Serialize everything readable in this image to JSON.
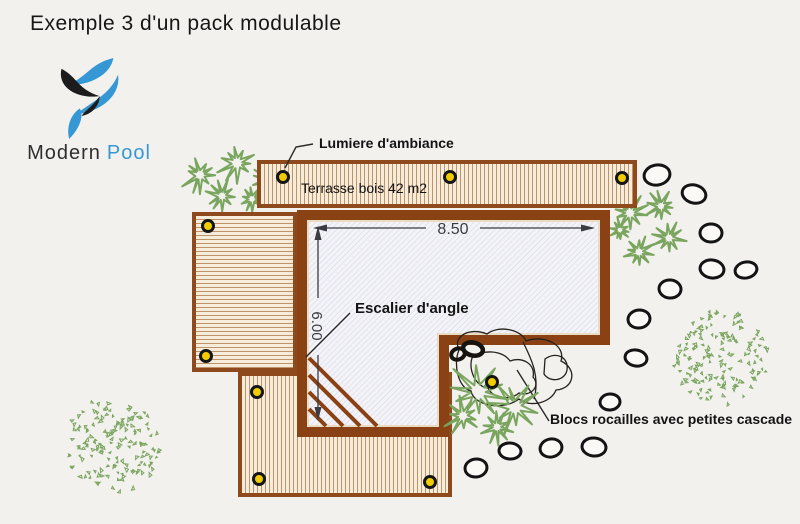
{
  "title": "Exemple 3 d'un pack modulable",
  "logo": {
    "brand_primary": "Modern",
    "brand_secondary": "Pool",
    "brand_primary_color": "#2e2e2e",
    "brand_secondary_color": "#3598d4"
  },
  "plan": {
    "labels": {
      "ambient_light": "Lumiere d'ambiance",
      "wood_deck": "Terrasse bois 42 m2",
      "corner_stairs": "Escalier d'angle",
      "rock_cascade": "Blocs rocailles avec petites cascade"
    },
    "dimensions": {
      "width": "8.50",
      "height": "6.00"
    },
    "colors": {
      "background": "#f2f1ee",
      "wood_border": "#8e4a1c",
      "wood_fill": "#f5ecdc",
      "wood_stripe": "#c09366",
      "pool_border": "#8a4113",
      "pool_fill": "#f3f3f8",
      "pool_hatch_line": "#d8d8e8",
      "light_yellow": "#f0cc00",
      "plant_green": "#7aa55f",
      "rock_outline": "#141414",
      "dim_color": "#3b3b42"
    }
  }
}
